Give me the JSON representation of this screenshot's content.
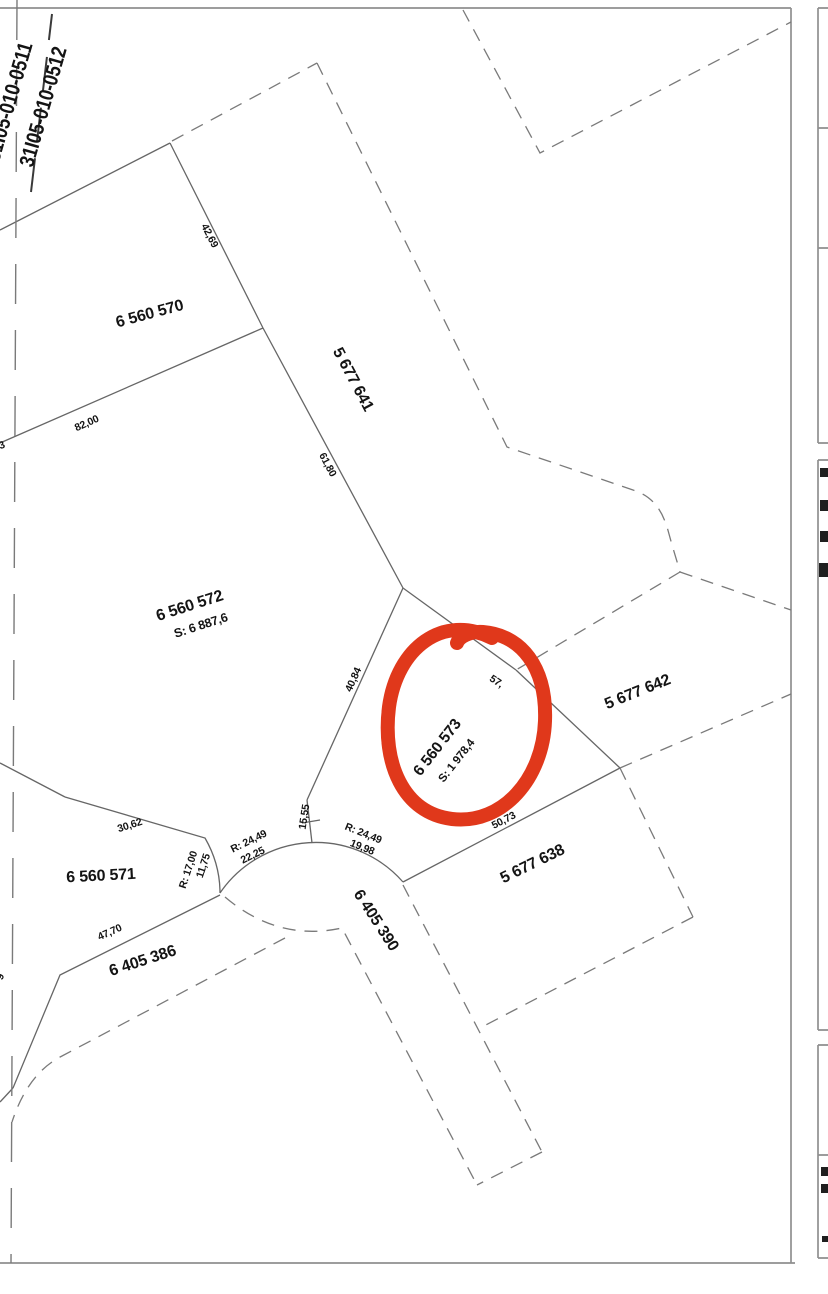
{
  "title": "Cadastral parcel map with highlighted lot",
  "colors": {
    "highlight": "#e0381b",
    "line": "#666666",
    "dash": "#7a7a7a",
    "border": "#8f8f8f",
    "text": "#141414"
  },
  "highlighted_parcel": {
    "id": "6 560 573",
    "area": "S: 1 978,4"
  },
  "map_sheets": [
    "31I05-010-0511",
    "31I05-010-0512"
  ],
  "parcels": [
    {
      "id": "6 560 570"
    },
    {
      "id": "6 560 571"
    },
    {
      "id": "6 560 572",
      "area": "S: 6 887,6"
    },
    {
      "id": "6 560 573",
      "area": "S: 1 978,4"
    },
    {
      "id": "5 677 641"
    },
    {
      "id": "5 677 642"
    },
    {
      "id": "5 677 638"
    }
  ],
  "roads": [
    "6 405 386",
    "6 405 390"
  ],
  "dimensions": [
    "42,69",
    "82,00",
    "61,80",
    "40,84",
    "15,55",
    "30,62",
    "11,75",
    "R: 17,00",
    "R: 24,49",
    "22,25",
    "R: 24,49",
    "19,98",
    "50,73",
    "57,",
    "47,70"
  ],
  "labels": [
    {
      "name": "sheet-label-31I05-010-0511",
      "text": "31I05-010-0511",
      "x": 10,
      "y": 102,
      "rot": -74,
      "size": 21,
      "w": 700,
      "sx": 0.85
    },
    {
      "name": "sheet-label-31I05-010-0512",
      "text": "31I05-010-0512",
      "x": 44,
      "y": 107,
      "rot": -74,
      "size": 21,
      "w": 700,
      "sx": 0.85
    },
    {
      "name": "parcel-label-6560570",
      "text": "6 560 570",
      "x": 150,
      "y": 315,
      "rot": -15,
      "size": 16,
      "w": 700
    },
    {
      "name": "parcel-label-5677641",
      "text": "5 677 641",
      "x": 352,
      "y": 380,
      "rot": 62,
      "size": 16,
      "w": 700
    },
    {
      "name": "parcel-label-6560572",
      "text": "6 560 572",
      "x": 190,
      "y": 607,
      "rot": -18,
      "size": 16,
      "w": 700
    },
    {
      "name": "area-label-6560572",
      "text": "S: 6 887,6",
      "x": 201,
      "y": 626,
      "rot": -18,
      "size": 12.5,
      "w": 700
    },
    {
      "name": "parcel-label-6560573",
      "text": "6 560 573",
      "x": 438,
      "y": 748,
      "rot": -52,
      "size": 15.5,
      "w": 700
    },
    {
      "name": "area-label-6560573",
      "text": "S: 1 978,4",
      "x": 457,
      "y": 761,
      "rot": -52,
      "size": 11.5,
      "w": 700
    },
    {
      "name": "parcel-label-5677642",
      "text": "5 677 642",
      "x": 638,
      "y": 693,
      "rot": -22,
      "size": 16,
      "w": 700
    },
    {
      "name": "parcel-label-5677638",
      "text": "5 677 638",
      "x": 533,
      "y": 865,
      "rot": -26,
      "size": 16,
      "w": 700
    },
    {
      "name": "parcel-label-6560571",
      "text": "6 560 571",
      "x": 101,
      "y": 877,
      "rot": -3,
      "size": 16,
      "w": 700
    },
    {
      "name": "road-label-6405386",
      "text": "6 405 386",
      "x": 143,
      "y": 962,
      "rot": -18,
      "size": 16,
      "w": 700
    },
    {
      "name": "road-label-6405390",
      "text": "6 405 390",
      "x": 375,
      "y": 921,
      "rot": 57,
      "size": 16,
      "w": 700
    },
    {
      "name": "dim-42-69",
      "text": "42,69",
      "x": 209,
      "y": 236,
      "rot": 63,
      "size": 10.5,
      "w": 700
    },
    {
      "name": "dim-82-00",
      "text": "82,00",
      "x": 87,
      "y": 424,
      "rot": -24,
      "size": 10.5,
      "w": 700
    },
    {
      "name": "dim-61-80",
      "text": "61,80",
      "x": 327,
      "y": 465,
      "rot": 62,
      "size": 10.5,
      "w": 700
    },
    {
      "name": "dim-40-84",
      "text": "40,84",
      "x": 354,
      "y": 680,
      "rot": -66,
      "size": 10.5,
      "w": 700
    },
    {
      "name": "dim-15-55",
      "text": "15,55",
      "x": 305,
      "y": 817,
      "rot": -81,
      "size": 10.5,
      "w": 700
    },
    {
      "name": "dim-30-62",
      "text": "30,62",
      "x": 130,
      "y": 826,
      "rot": -18,
      "size": 10.5,
      "w": 700
    },
    {
      "name": "dim-11-75",
      "text": "11,75",
      "x": 204,
      "y": 866,
      "rot": -72,
      "size": 10.5,
      "w": 700
    },
    {
      "name": "dim-r-17-00",
      "text": "R: 17,00",
      "x": 189,
      "y": 870,
      "rot": -72,
      "size": 10.5,
      "w": 700
    },
    {
      "name": "dim-r-24-49-left",
      "text": "R: 24,49",
      "x": 249,
      "y": 842,
      "rot": -26,
      "size": 10.5,
      "w": 700
    },
    {
      "name": "dim-22-25",
      "text": "22,25",
      "x": 253,
      "y": 856,
      "rot": -26,
      "size": 10.5,
      "w": 700
    },
    {
      "name": "dim-r-24-49-right",
      "text": "R: 24,49",
      "x": 363,
      "y": 834,
      "rot": 22,
      "size": 10.5,
      "w": 700
    },
    {
      "name": "dim-19-98",
      "text": "19,98",
      "x": 362,
      "y": 848,
      "rot": 22,
      "size": 10.5,
      "w": 700
    },
    {
      "name": "dim-50-73",
      "text": "50,73",
      "x": 504,
      "y": 821,
      "rot": -27,
      "size": 10.5,
      "w": 700
    },
    {
      "name": "dim-57",
      "text": "57,",
      "x": 496,
      "y": 682,
      "rot": 33,
      "size": 10.5,
      "w": 700
    },
    {
      "name": "dim-47-70",
      "text": "47,70",
      "x": 110,
      "y": 933,
      "rot": -24,
      "size": 10.5,
      "w": 700
    },
    {
      "name": "edge-fragment-3",
      "text": "3",
      "x": 2,
      "y": 446,
      "rot": -20,
      "size": 10.5,
      "w": 700
    },
    {
      "name": "edge-fragment-9",
      "text": "9",
      "x": 1,
      "y": 977,
      "rot": -70,
      "size": 10.5,
      "w": 700
    }
  ]
}
